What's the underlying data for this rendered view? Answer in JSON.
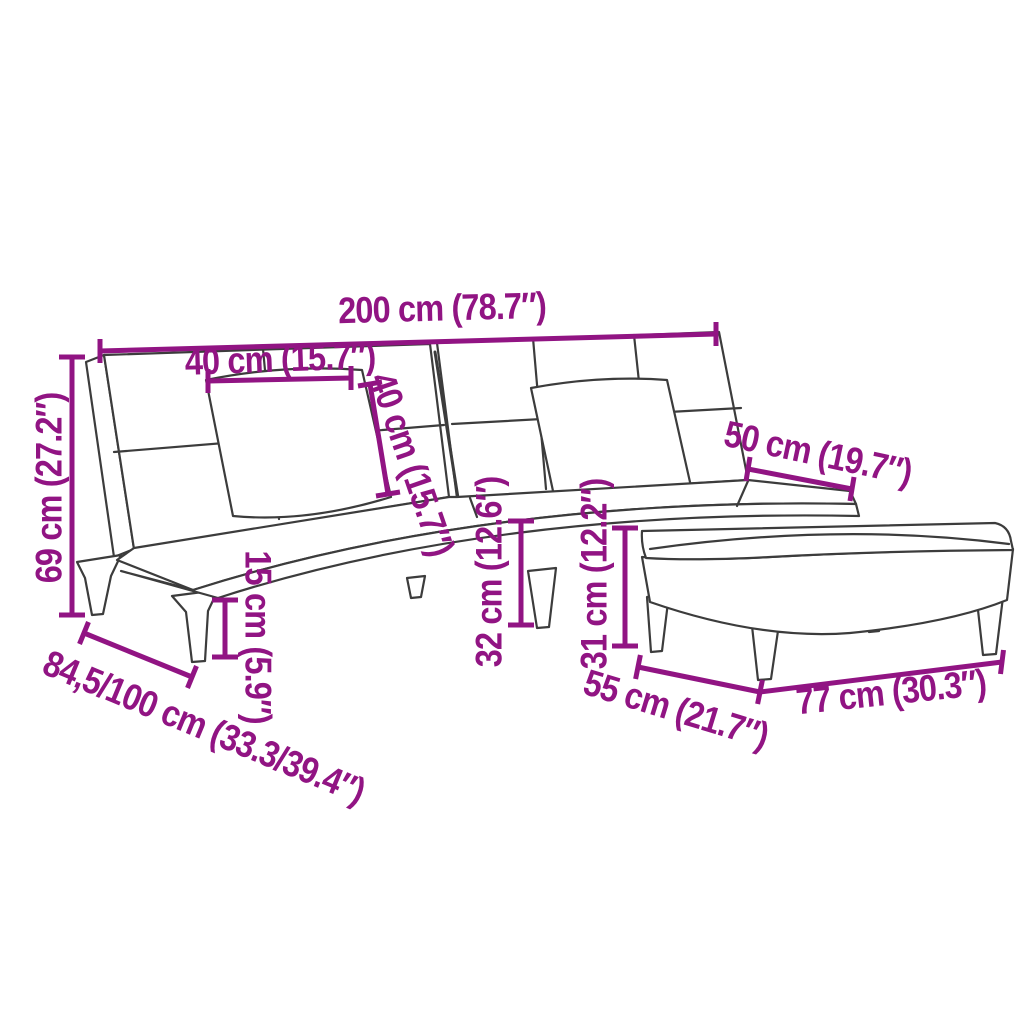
{
  "meta": {
    "type": "product-dimension-diagram",
    "subject": "sofa bed with cushions and footstool"
  },
  "colors": {
    "accent": "#911483",
    "line": "#3C3C3C",
    "background": "#FFFFFF"
  },
  "dimensions": {
    "total_width": "200 cm (78.7″)",
    "cushion_width": "40 cm (15.7″)",
    "cushion_height": "40 cm (15.7″)",
    "total_height": "69 cm (27.2″)",
    "seat_extension_depth": "50 cm (19.7″)",
    "leg_height": "15 cm (5.9″)",
    "seat_height": "32 cm (12.6″)",
    "footstool_height": "31 cm (12.2″)",
    "depth_range": "84,5/100 cm (33.3/39.4″)",
    "footstool_depth": "55 cm (21.7″)",
    "footstool_width": "77 cm (30.3″)"
  }
}
